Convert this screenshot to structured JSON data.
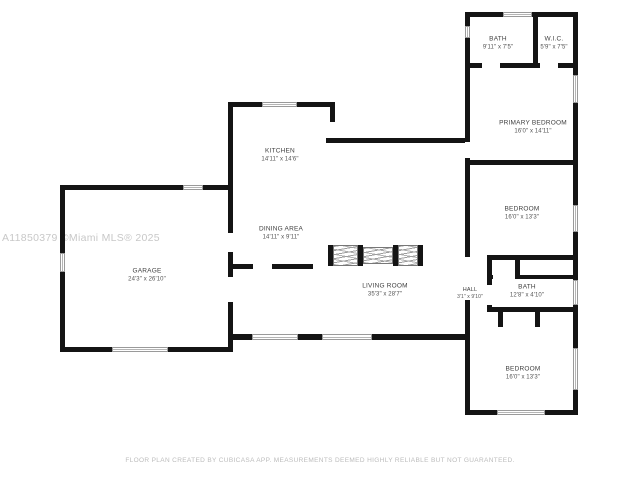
{
  "watermark": "A11850379 ©Miami MLS® 2025",
  "disclaimer": "FLOOR PLAN CREATED BY CUBICASA APP. MEASUREMENTS DEEMED HIGHLY RELIABLE BUT NOT GUARANTEED.",
  "rooms": [
    {
      "id": "bath-1",
      "name": "BATH",
      "dims": "9'11\" x 7'5\""
    },
    {
      "id": "wic",
      "name": "W.I.C.",
      "dims": "5'9\" x 7'5\""
    },
    {
      "id": "primary-bedroom",
      "name": "PRIMARY BEDROOM",
      "dims": "16'0\" x 14'11\""
    },
    {
      "id": "kitchen",
      "name": "KITCHEN",
      "dims": "14'11\" x 14'6\""
    },
    {
      "id": "dining-area",
      "name": "DINING AREA",
      "dims": "14'11\" x 9'11\""
    },
    {
      "id": "bedroom-1",
      "name": "BEDROOM",
      "dims": "16'0\" x 13'3\""
    },
    {
      "id": "hall",
      "name": "HALL",
      "dims": "3'1\" x 9'10\""
    },
    {
      "id": "bath-2",
      "name": "BATH",
      "dims": "12'8\" x 4'10\""
    },
    {
      "id": "living-room",
      "name": "LIVING ROOM",
      "dims": "35'3\" x 28'7\""
    },
    {
      "id": "garage",
      "name": "GARAGE",
      "dims": "24'3\" x 26'10\""
    },
    {
      "id": "bedroom-2",
      "name": "BEDROOM",
      "dims": "16'0\" x 13'3\""
    }
  ],
  "colors": {
    "wall": "#141414",
    "window_outline": "#9a9a9a",
    "label": "#3f3f3f",
    "watermark": "#c8c8c8",
    "disclaimer": "#bcbcbc",
    "background": "#ffffff"
  }
}
